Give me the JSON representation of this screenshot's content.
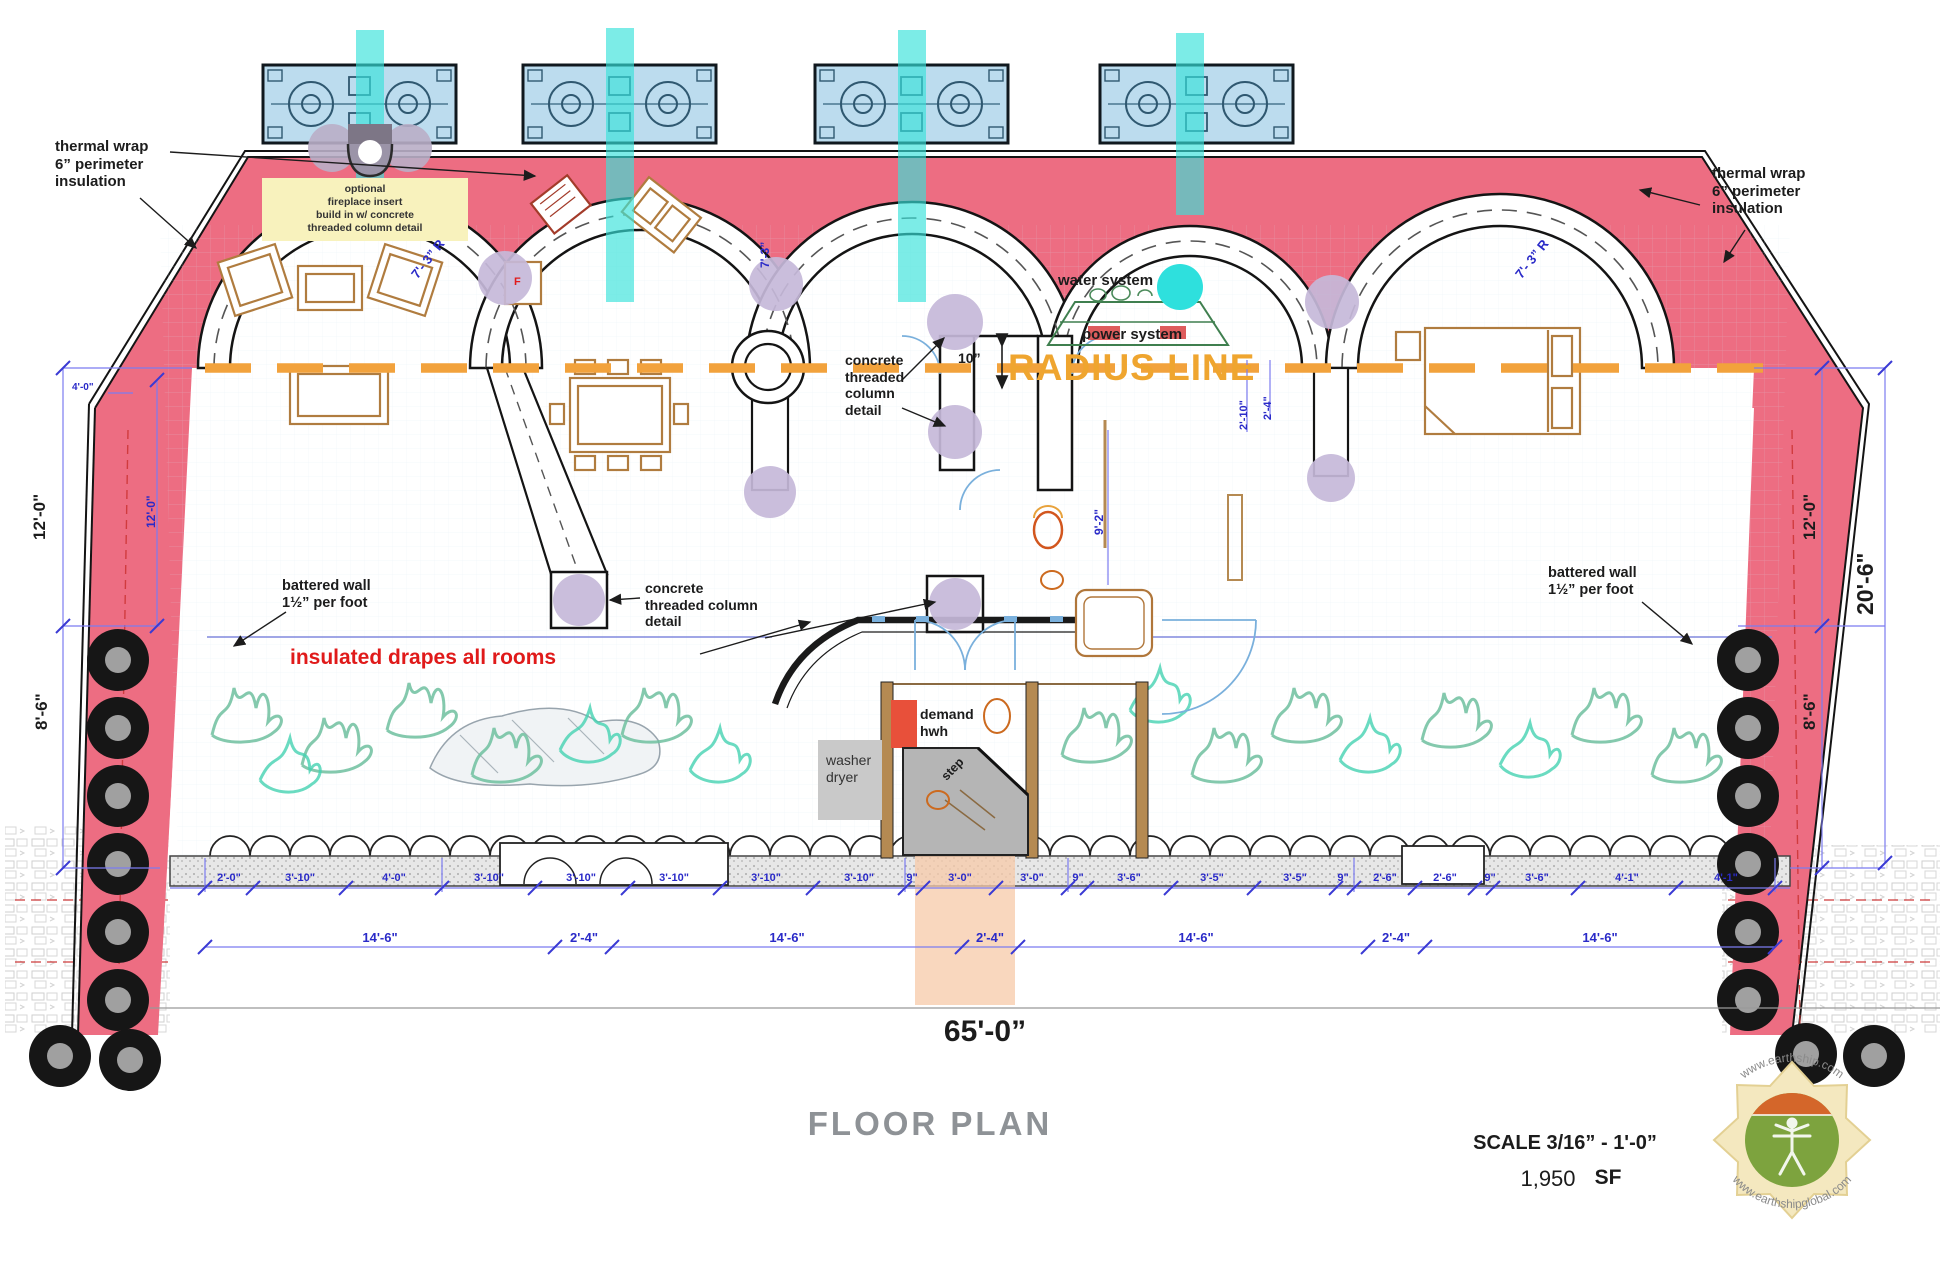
{
  "annotations": {
    "thermal_left": "thermal wrap\n6” perimeter\ninsulation",
    "thermal_right": "thermal wrap\n6” perimeter\ninsulation",
    "fireplace_note": "optional\nfireplace insert\nbuild in w/ concrete\nthreaded column detail",
    "radius_r_left": "7'- 3” R",
    "radius_vertical": "7'-3”",
    "radius_r_right": "7'- 3” R",
    "water_system": "water system",
    "power_system": "power system",
    "radius_line": "RADIUS LINE",
    "concrete_mid": "concrete\nthreaded\ncolumn\ndetail",
    "concrete_left": "concrete\nthreaded column\ndetail",
    "battered_left": "battered wall\n1½” per foot",
    "battered_right": "battered wall\n1½” per foot",
    "insulated_drapes": "insulated drapes all rooms",
    "demand_hwh": "demand\nhwh",
    "washer_dryer": "washer\ndryer",
    "step": "step",
    "fridge": "F"
  },
  "dimensions": {
    "row1": [
      "2'-0\"",
      "3'-10\"",
      "4'-0\"",
      "3'-10\"",
      "3'-10\"",
      "3'-10\"",
      "3'-10\"",
      "3'-10\"",
      "9\"",
      "3'-0\"",
      "3'-0\"",
      "9\"",
      "3'-6\"",
      "3'-5\"",
      "3'-5\"",
      "9\"",
      "2'-6\"",
      "2'-6\"",
      "9\"",
      "3'-6\"",
      "4'-1\"",
      "4'-1\""
    ],
    "row2": [
      "14'-6\"",
      "2'-4\"",
      "14'-6\"",
      "2'-4\"",
      "14'-6\"",
      "2'-4\"",
      "14'-6\""
    ],
    "left_outer_top": "12'-0\"",
    "left_outer_bottom": "8'-6\"",
    "left_inner": "12'-0\"",
    "left_small": "4'-0\"",
    "right_outer_top": "12'-0\"",
    "right_outer_bottom": "8'-6\"",
    "right_total": "20'-6\"",
    "center_room": "9'-2\"",
    "hall_upper": "2'-10\"",
    "hall_lower": "2'-4\"",
    "wall_thickness": "10”",
    "overall": "65'-0”"
  },
  "footer": {
    "title": "FLOOR PLAN",
    "scale": "SCALE 3/16” - 1'-0”",
    "area_value": "1,950",
    "area_unit": "SF"
  },
  "logo": {
    "top_url": "www.earthship.com",
    "bottom_url": "www.earthshipglobal.com"
  },
  "colors": {
    "insulation_pink": "#ed6d82",
    "radius_orange": "#f2a23c",
    "cooling_cyan": "#35e2da",
    "module_blue": "#bcdcee",
    "column_lavender": "#c6b9d9",
    "plant_green": "#6fbf9f",
    "alert_red": "#e8503a",
    "dim_blue": "#2a2ac8"
  }
}
